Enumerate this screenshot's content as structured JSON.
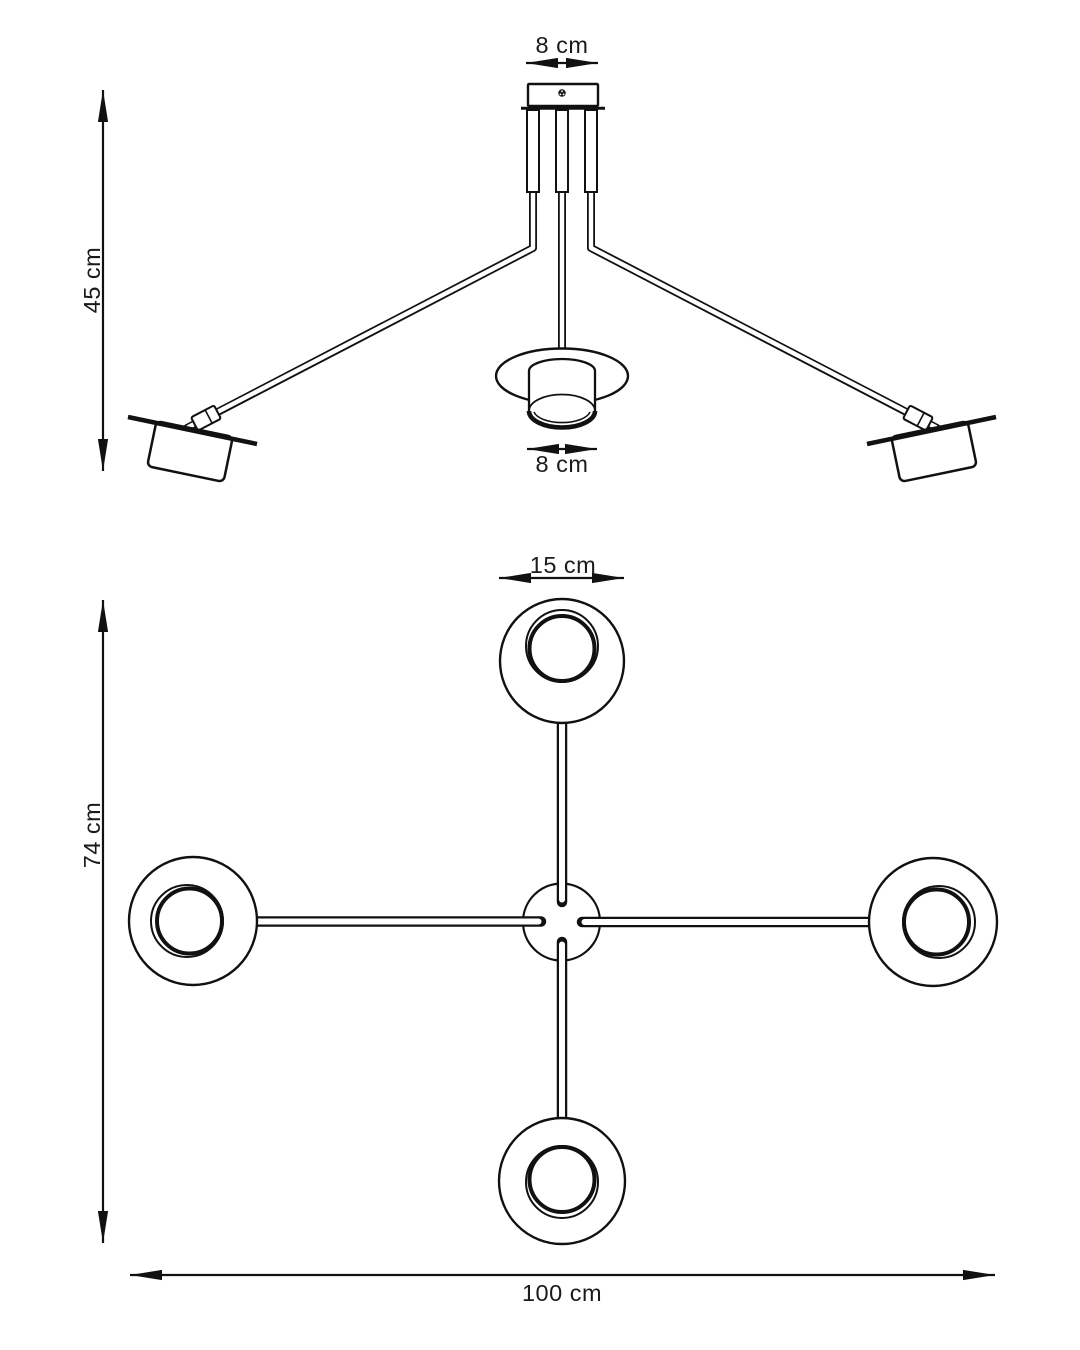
{
  "figure": {
    "background": "#ffffff",
    "line_color": "#111111",
    "text_color": "#1a1a1a"
  },
  "side_view": {
    "canopy_width_label": "8 cm",
    "height_label": "45 cm",
    "shade_width_label": "8 cm"
  },
  "plan_view": {
    "shade_diameter_label": "15 cm",
    "vertical_span_label": "74 cm",
    "horizontal_span_label": "100 cm"
  }
}
